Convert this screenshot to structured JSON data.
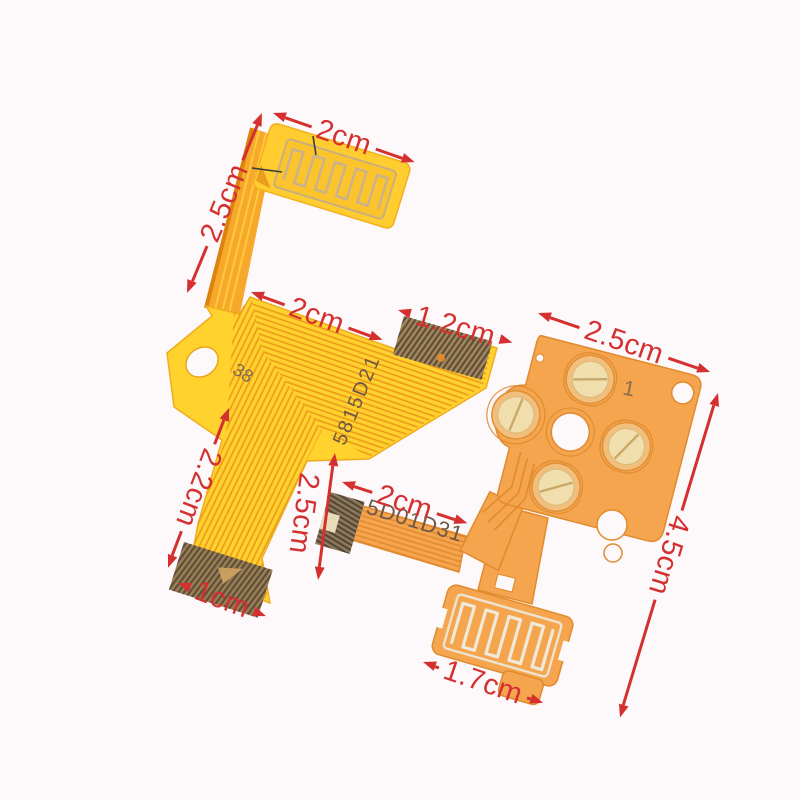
{
  "photo": {
    "description": "Two replacement flexible printed circuit ribbon cables on a white background with red dimension annotations",
    "background_color": "#fdf9fb",
    "colors": {
      "annotation_red": "#d53030",
      "left_flex_yellow": "#ffd22e",
      "left_flex_pad_yellow": "#ffcd2f",
      "trace_orange": "#ee9b1c",
      "neck_strip_orange": "#f6a82c",
      "right_flex_orange": "#f5a54d",
      "button_pad_cream": "#f0dfac",
      "connector_bronze": "#5e4d3a",
      "serpentine_silver": "#efe9da"
    }
  },
  "annotations": {
    "color": "#d53030",
    "dimensions": [
      {
        "name": "left-pad-width",
        "label": "2cm"
      },
      {
        "name": "left-neck-length",
        "label": "2.5cm"
      },
      {
        "name": "left-body-width",
        "label": "2cm"
      },
      {
        "name": "left-connector-width",
        "label": "1.2cm"
      },
      {
        "name": "board-width",
        "label": "2.5cm"
      },
      {
        "name": "board-height",
        "label": "4.5cm"
      },
      {
        "name": "left-tail-length",
        "label": "2.2cm"
      },
      {
        "name": "left-tail-side",
        "label": "2.5cm"
      },
      {
        "name": "left-tail-connector-width",
        "label": "1cm"
      },
      {
        "name": "right-ribbon-length",
        "label": "2cm"
      },
      {
        "name": "bottom-pad-width",
        "label": "1.7cm"
      }
    ]
  },
  "markings": {
    "left_cable_part_number": "5815D21",
    "left_cable_code": "38",
    "right_cable_part_number": "5D01D31",
    "board_mark": "1"
  }
}
